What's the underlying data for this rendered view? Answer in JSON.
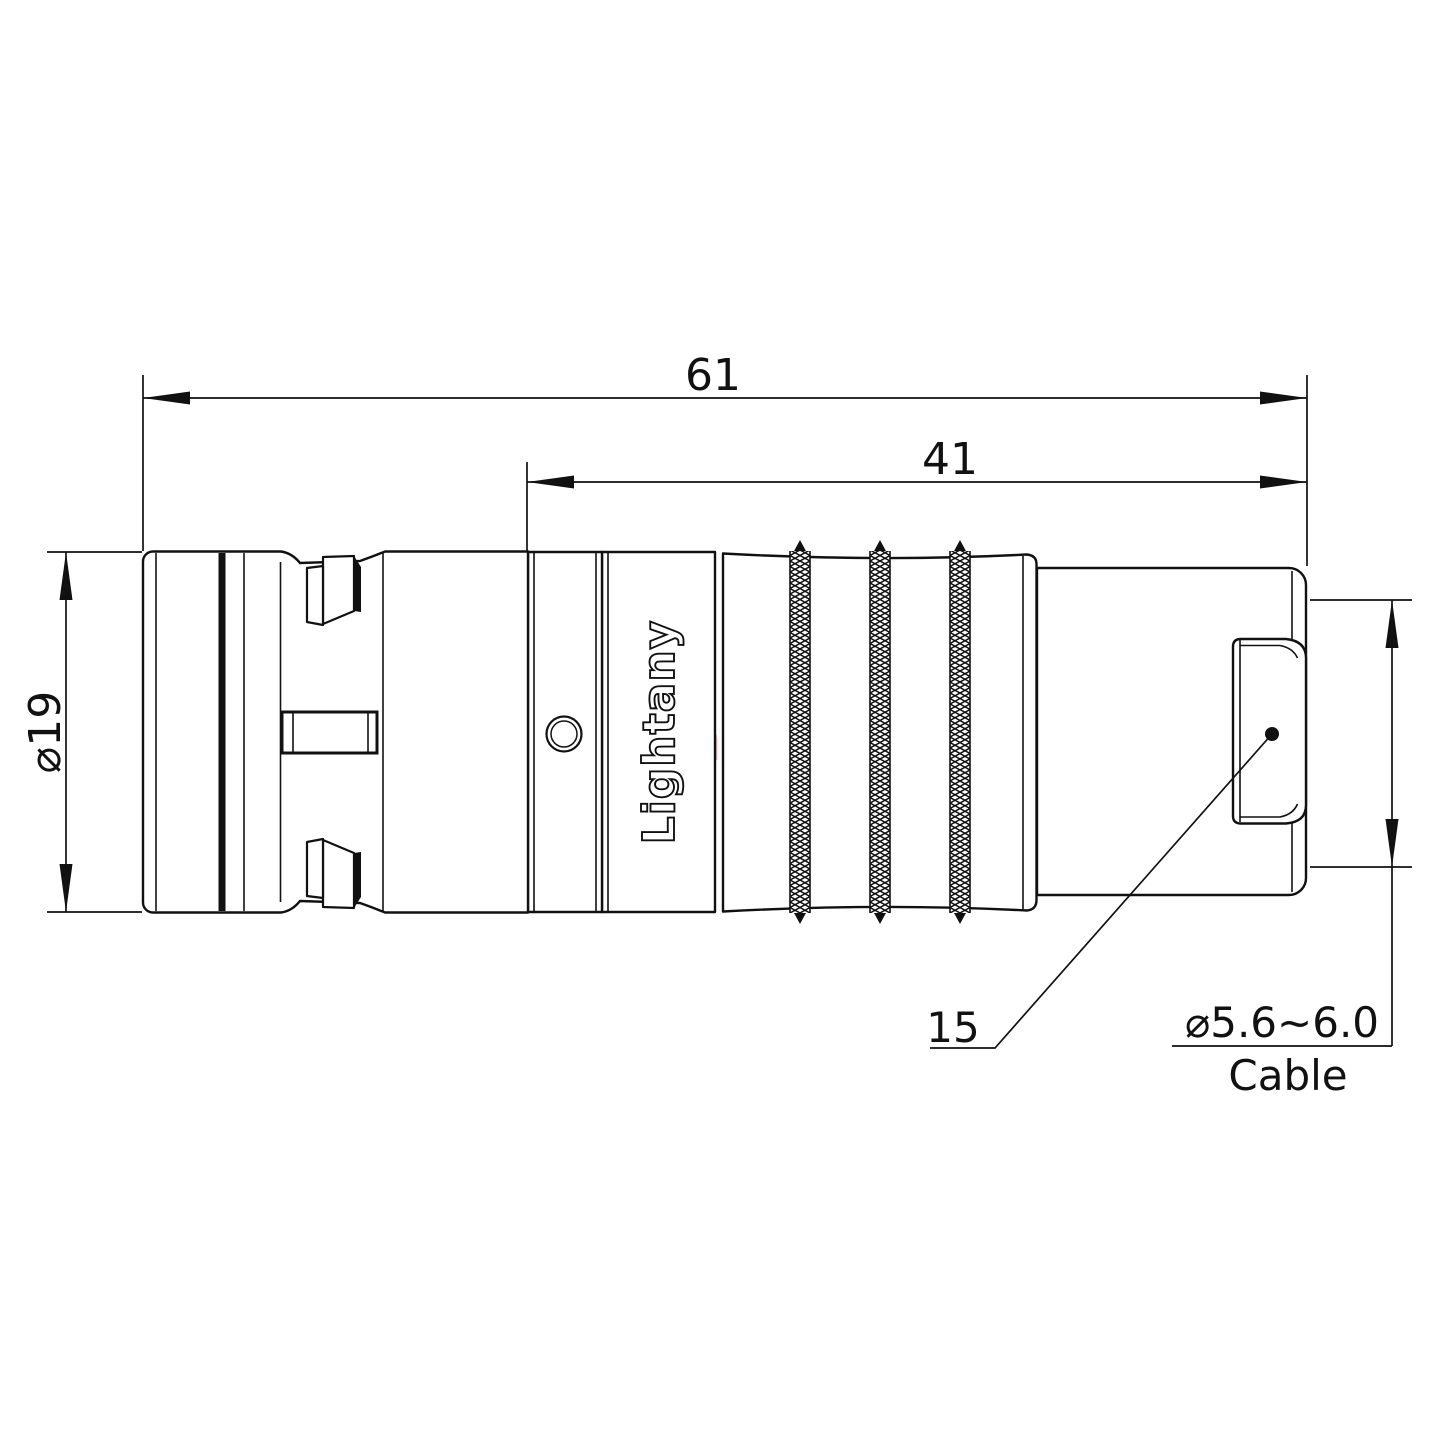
{
  "title": "Connector technical drawing",
  "engraving": {
    "text": "Lightany"
  },
  "watermark": {
    "text": "Lightany",
    "color": "#eda9a9"
  },
  "dimensions": {
    "overall_length": "61",
    "rear_section_length": "41",
    "front_shell_diameter": "⌀19",
    "cable_diameter_range": "⌀5.6~6.0",
    "cable_word": "Cable",
    "bushing_callout": "15"
  },
  "features": {
    "knurl_band_count": 3
  },
  "colors": {
    "line": "#111111",
    "background": "#ffffff",
    "watermark": "#eda9a9"
  }
}
